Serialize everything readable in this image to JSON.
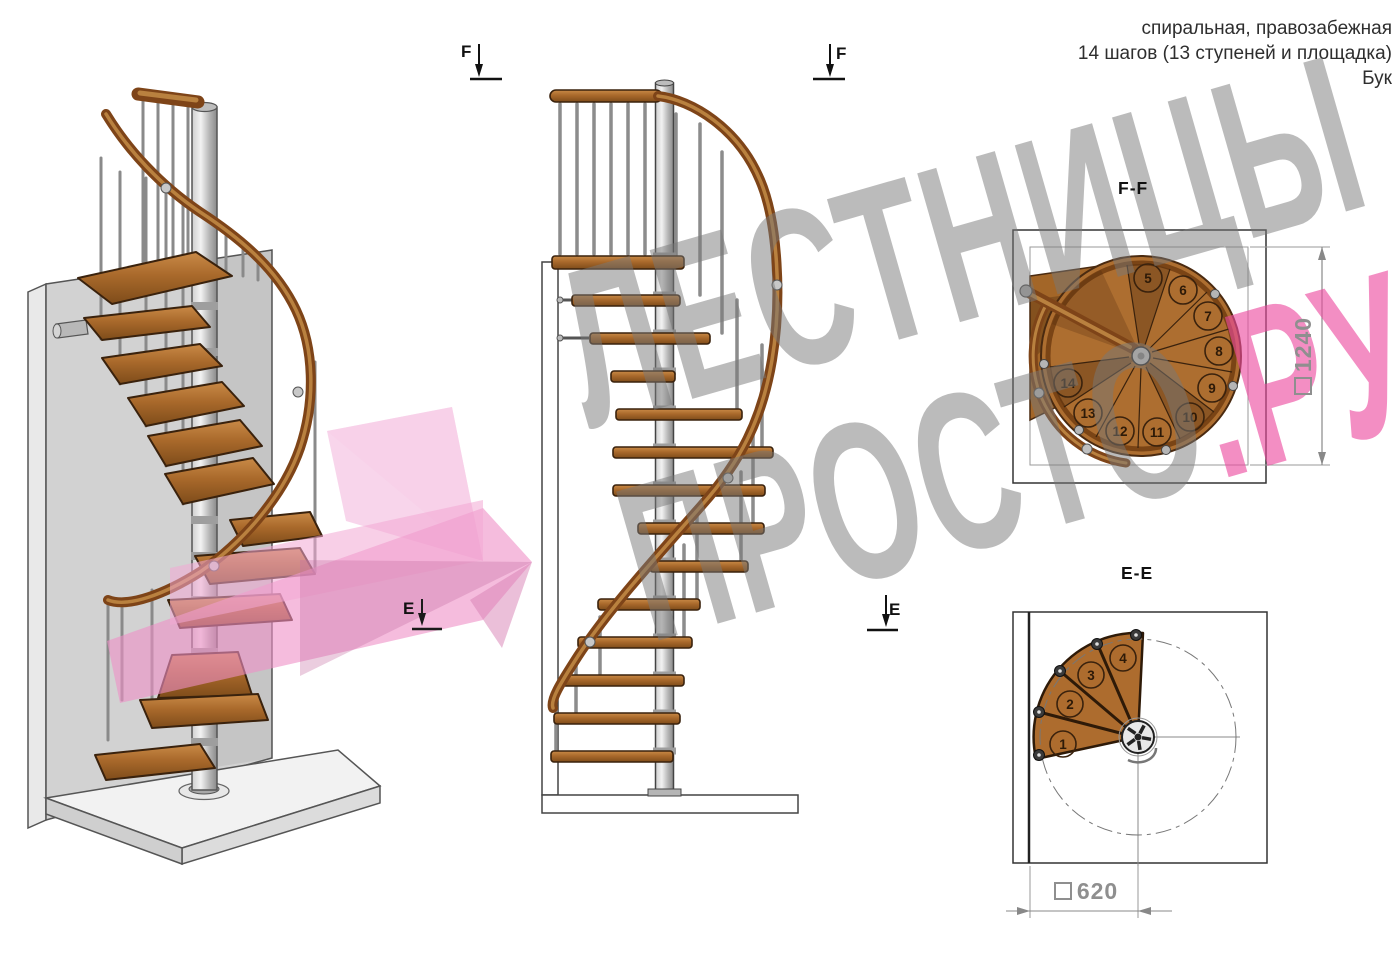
{
  "header": {
    "line1": "спиральная, правозабежная",
    "line2": "14 шагов (13 ступеней и площадка)",
    "line3": "Бук"
  },
  "watermark": {
    "line1": "ЛЕСТНИЦЫ",
    "line2_gray": "ПРОСТО",
    "line2_pink": ".РУ",
    "gray_color": "#787878",
    "pink_color": "#ec499e"
  },
  "sections": {
    "ff": {
      "title": "F-F",
      "dimension": {
        "symbol": "square",
        "value": "1240"
      },
      "steps": [
        "5",
        "6",
        "7",
        "8",
        "9",
        "10",
        "11",
        "12",
        "13",
        "14"
      ]
    },
    "ee": {
      "title": "E-E",
      "dimension": {
        "symbol": "square",
        "value": "620"
      },
      "steps": [
        "1",
        "2",
        "3",
        "4"
      ]
    }
  },
  "markers": {
    "f": "F",
    "e": "E"
  },
  "colors": {
    "wood": "#a9692b",
    "wood_dark": "#7e4c1a",
    "rail": "#7e4418",
    "metal": "#c8c8c8",
    "pink_arrow": "#ee8fc7",
    "line": "#444444"
  }
}
